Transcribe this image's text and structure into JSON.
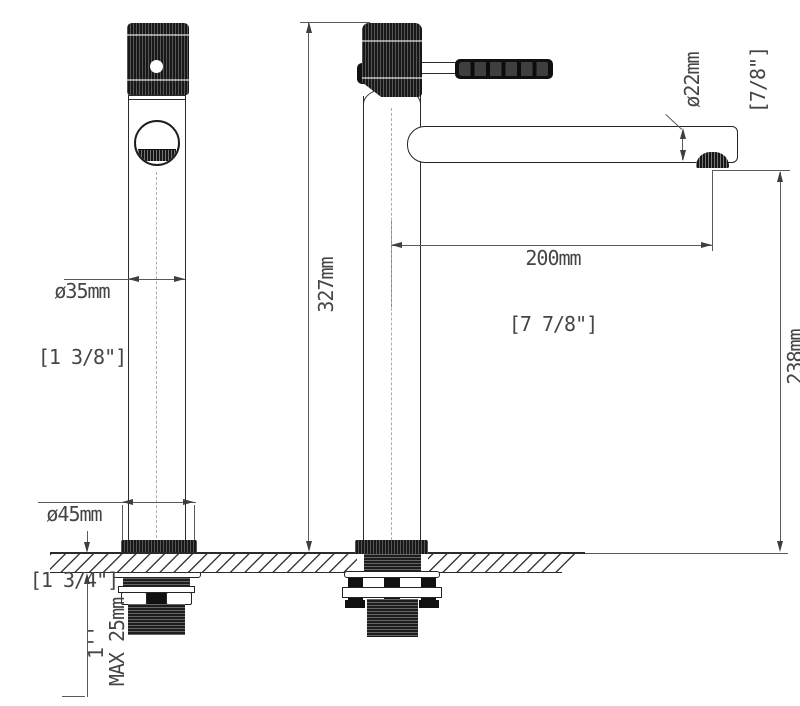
{
  "drawing": {
    "type": "technical-drawing",
    "subject": "tall single-lever basin faucet, front and side views with mounting hardware",
    "colors": {
      "background": "#ffffff",
      "object_line": "#2b2b2b",
      "dimension_line": "#5a5a5a",
      "text": "#454545",
      "dark_fill": "#181818"
    },
    "dimensions": {
      "body_diameter": {
        "value": "ø35mm",
        "inches": "[1 3/8\"]"
      },
      "base_diameter": {
        "value": "ø45mm",
        "inches": "[1 3/4\"]"
      },
      "total_height": {
        "value": "327mm",
        "inches": "[12 7/8\"]"
      },
      "spout_reach": {
        "value": "200mm",
        "inches": "[7 7/8\"]"
      },
      "spout_diameter": {
        "value": "ø22mm",
        "inches": "[7/8\"]"
      },
      "outlet_height": {
        "value": "238mm",
        "inches": "[9 3/8\"]"
      },
      "deck_thickness": {
        "value": "MAX 25mm"
      },
      "thread_size": {
        "value": "1''"
      }
    }
  }
}
